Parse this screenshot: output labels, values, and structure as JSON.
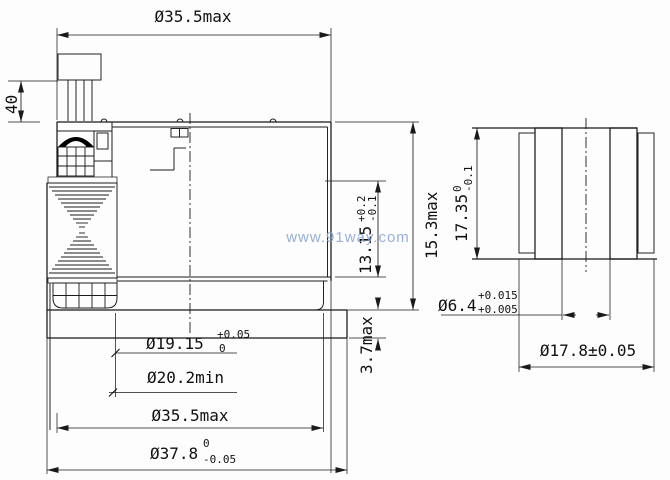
{
  "watermark": {
    "text": "www.91way.com",
    "color": "#8ea6d6"
  },
  "left_view": {
    "dims": {
      "top_od": {
        "text": "Ø35.5max"
      },
      "lead_length": {
        "text": "40"
      },
      "bore_depth": {
        "main": "13.15",
        "tol_upper": "+0.2",
        "tol_lower": "-0.1"
      },
      "inner_height": {
        "text": "15.3max"
      },
      "flange_thickness": {
        "text": "3.7max"
      },
      "bore_dia": {
        "main": "Ø19.15",
        "tol_upper": "+0.05",
        "tol_lower": "0"
      },
      "counterbore_dia": {
        "text": "Ø20.2min"
      },
      "bottom_od": {
        "text": "Ø35.5max"
      },
      "flange_od": {
        "main": "Ø37.8",
        "tol_upper": "0",
        "tol_lower": "-0.05"
      }
    }
  },
  "right_view": {
    "dims": {
      "height": {
        "main": "17.35",
        "tol_upper": "0",
        "tol_lower": "-0.1"
      },
      "bore_dia": {
        "main": "Ø6.4",
        "tol_upper": "+0.015",
        "tol_lower": "+0.005"
      },
      "od": {
        "text": "Ø17.8±0.05"
      }
    }
  }
}
